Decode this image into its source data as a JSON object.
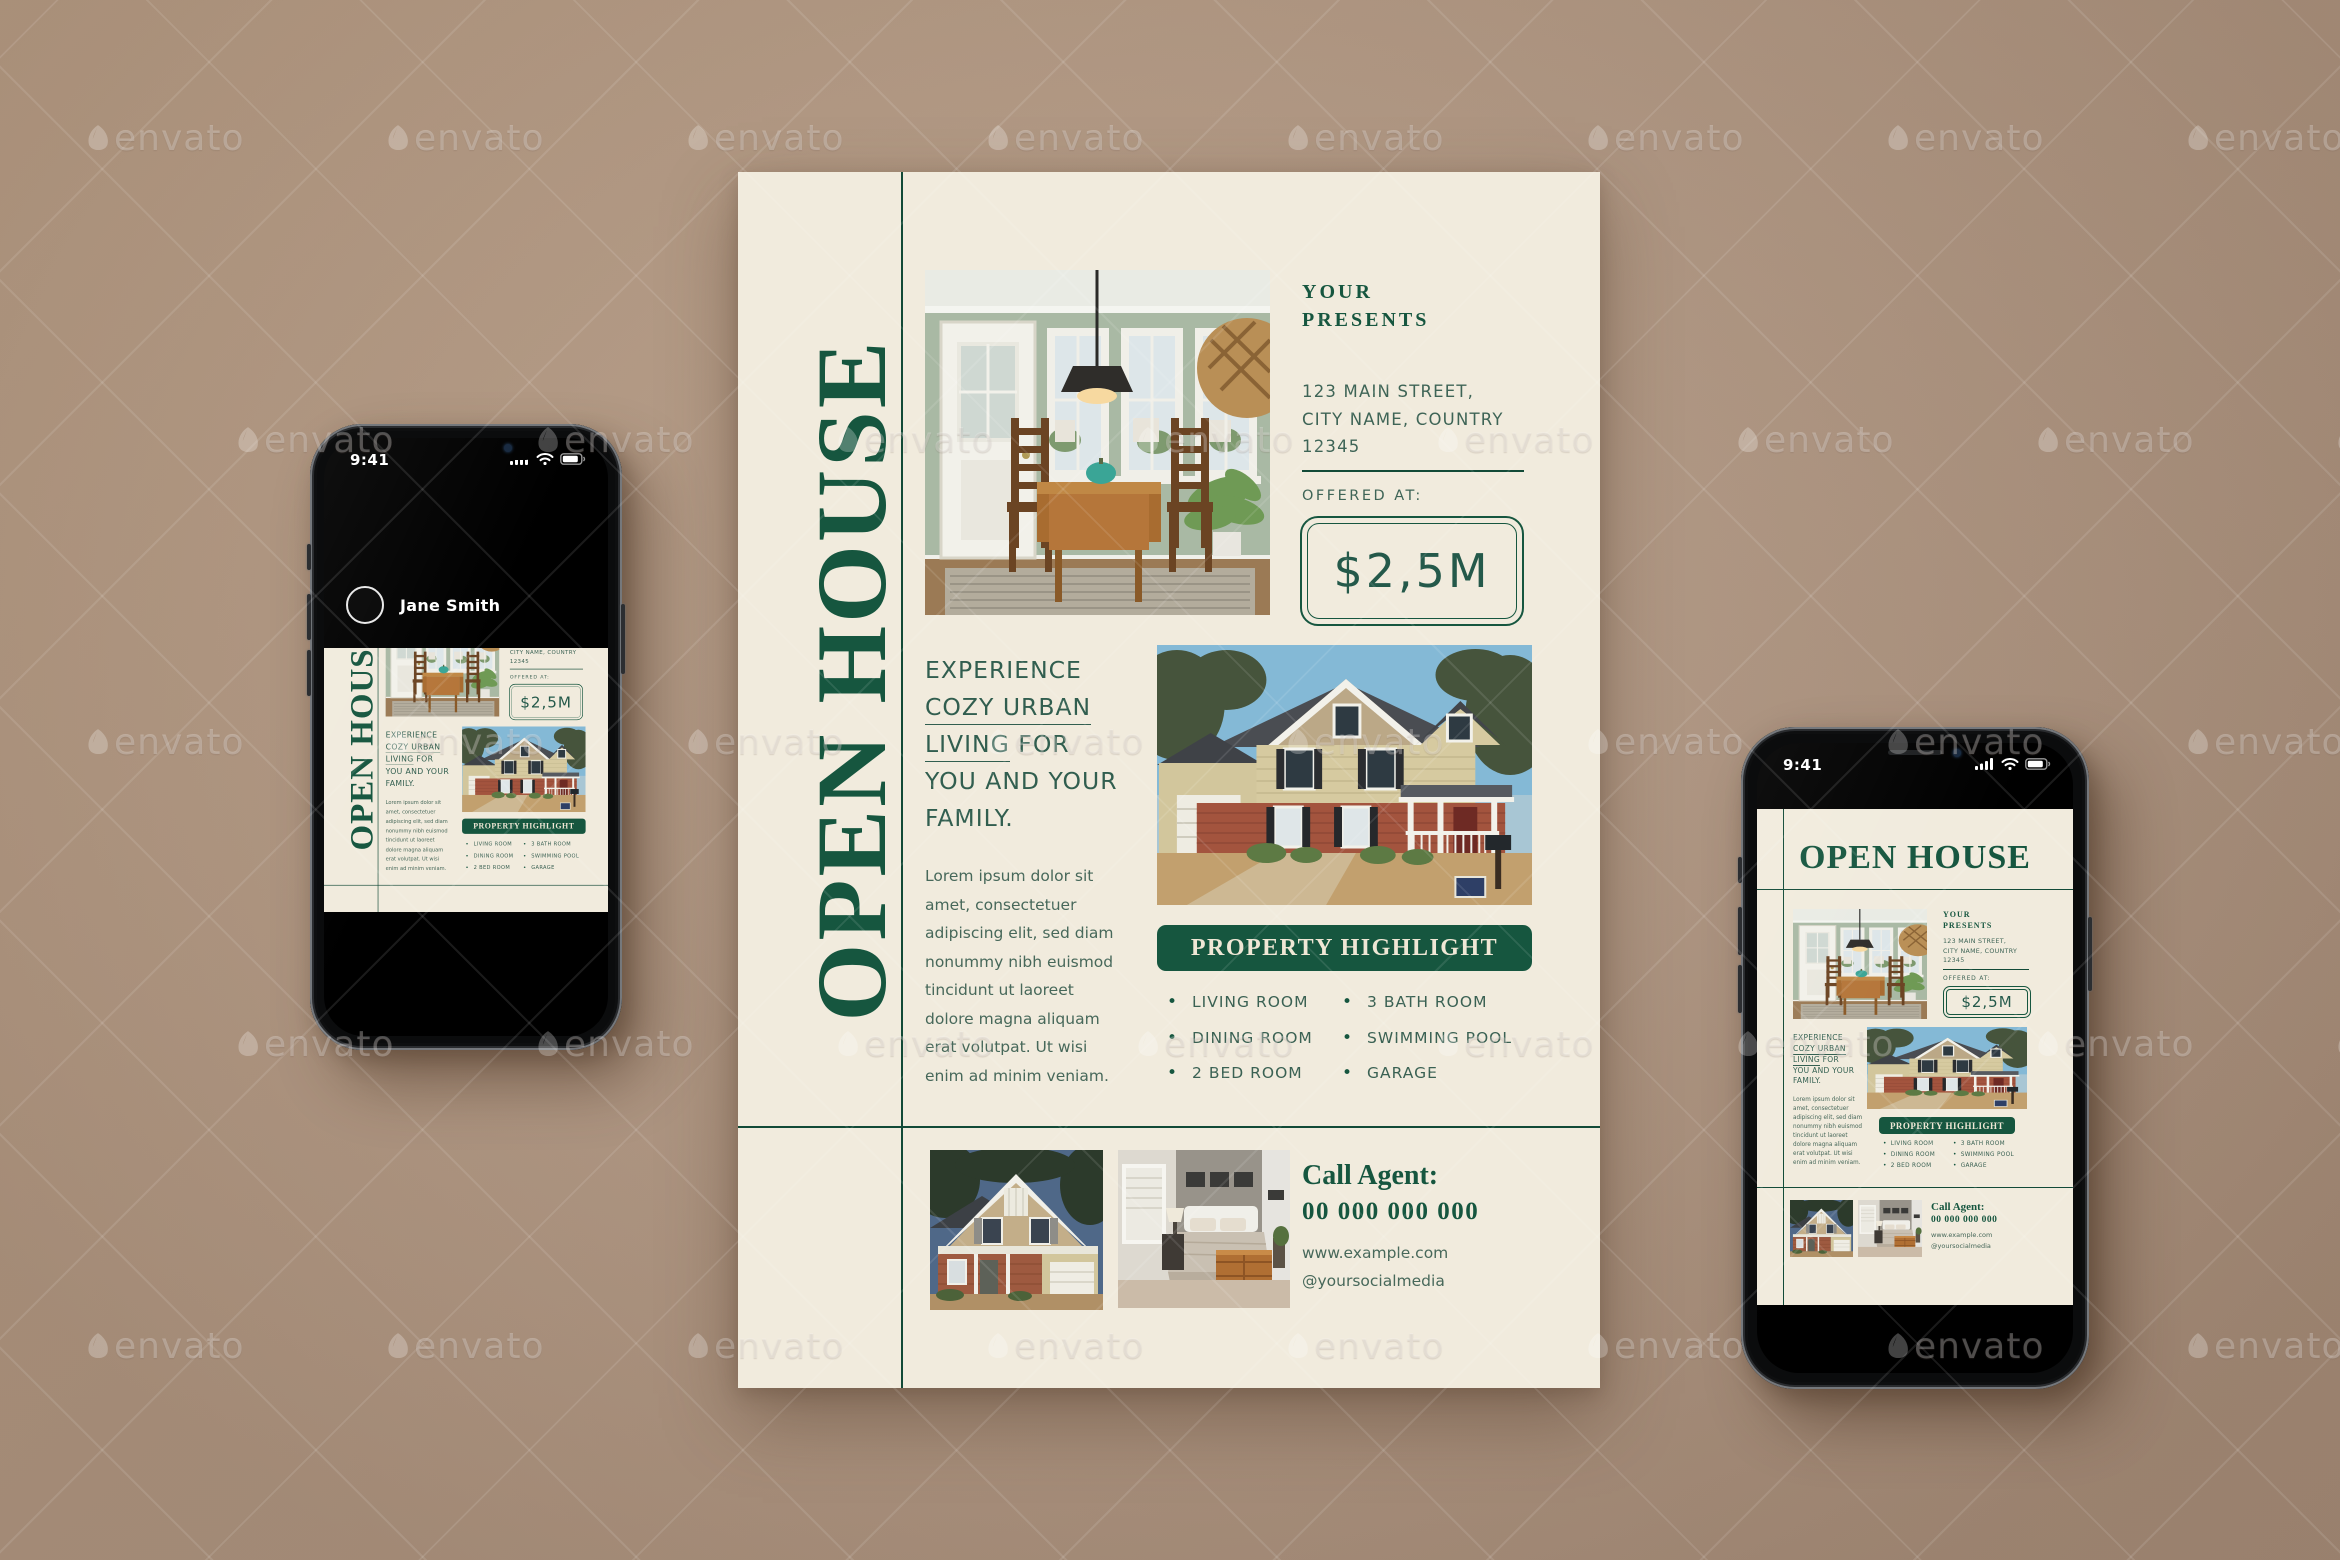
{
  "background": {
    "color_top": "#BCA189",
    "color_bottom": "#A98F7B"
  },
  "watermark": {
    "label": "envato",
    "rows": 5,
    "cols": 8,
    "x_start": 85,
    "y_start": 118,
    "x_step": 300,
    "y_step": 302,
    "odd_row_offset": 150
  },
  "flyer": {
    "title": "OPEN HOUSE",
    "presenter_line1": "YOUR",
    "presenter_line2": "PRESENTS",
    "address_lines": [
      "123 MAIN STREET,",
      "CITY NAME, COUNTRY",
      "12345"
    ],
    "offered_label": "OFFERED AT:",
    "price": "$2,5M",
    "headline": {
      "line1": "EXPERIENCE",
      "line2": "COZY URBAN",
      "line3a": "LIVING",
      "line3b": " FOR",
      "line4": "YOU AND YOUR",
      "line5": "FAMILY."
    },
    "body_text": "Lorem ipsum dolor sit amet, consectetuer adipiscing elit, sed diam nonummy nibh euismod tincidunt ut laoreet dolore magna aliquam erat volutpat. Ut wisi enim ad minim veniam.",
    "highlight_title": "PROPERTY HIGHLIGHT",
    "highlights_col1": [
      "LIVING ROOM",
      "DINING ROOM",
      "2 BED ROOM"
    ],
    "highlights_col2": [
      "3 BATH ROOM",
      "SWIMMING POOL",
      "GARAGE"
    ],
    "agent_label": "Call Agent:",
    "agent_phone": "00 000 000 000",
    "agent_website": "www.example.com",
    "agent_social": "@yoursocialmedia",
    "photos": [
      "dining-room",
      "house-exterior",
      "house-exterior-2",
      "bedroom"
    ],
    "colors": {
      "green": "#16563F",
      "cream": "#F1EBDD",
      "body_text": "#47685A",
      "background_tan": "#B49A85"
    }
  },
  "phone_left": {
    "status_time": "9:41",
    "status_icons": [
      "signal",
      "wifi",
      "battery"
    ],
    "profile_name": "Jane Smith"
  },
  "phone_right": {
    "status_time": "9:41",
    "status_icons": [
      "signal",
      "wifi",
      "battery"
    ]
  }
}
